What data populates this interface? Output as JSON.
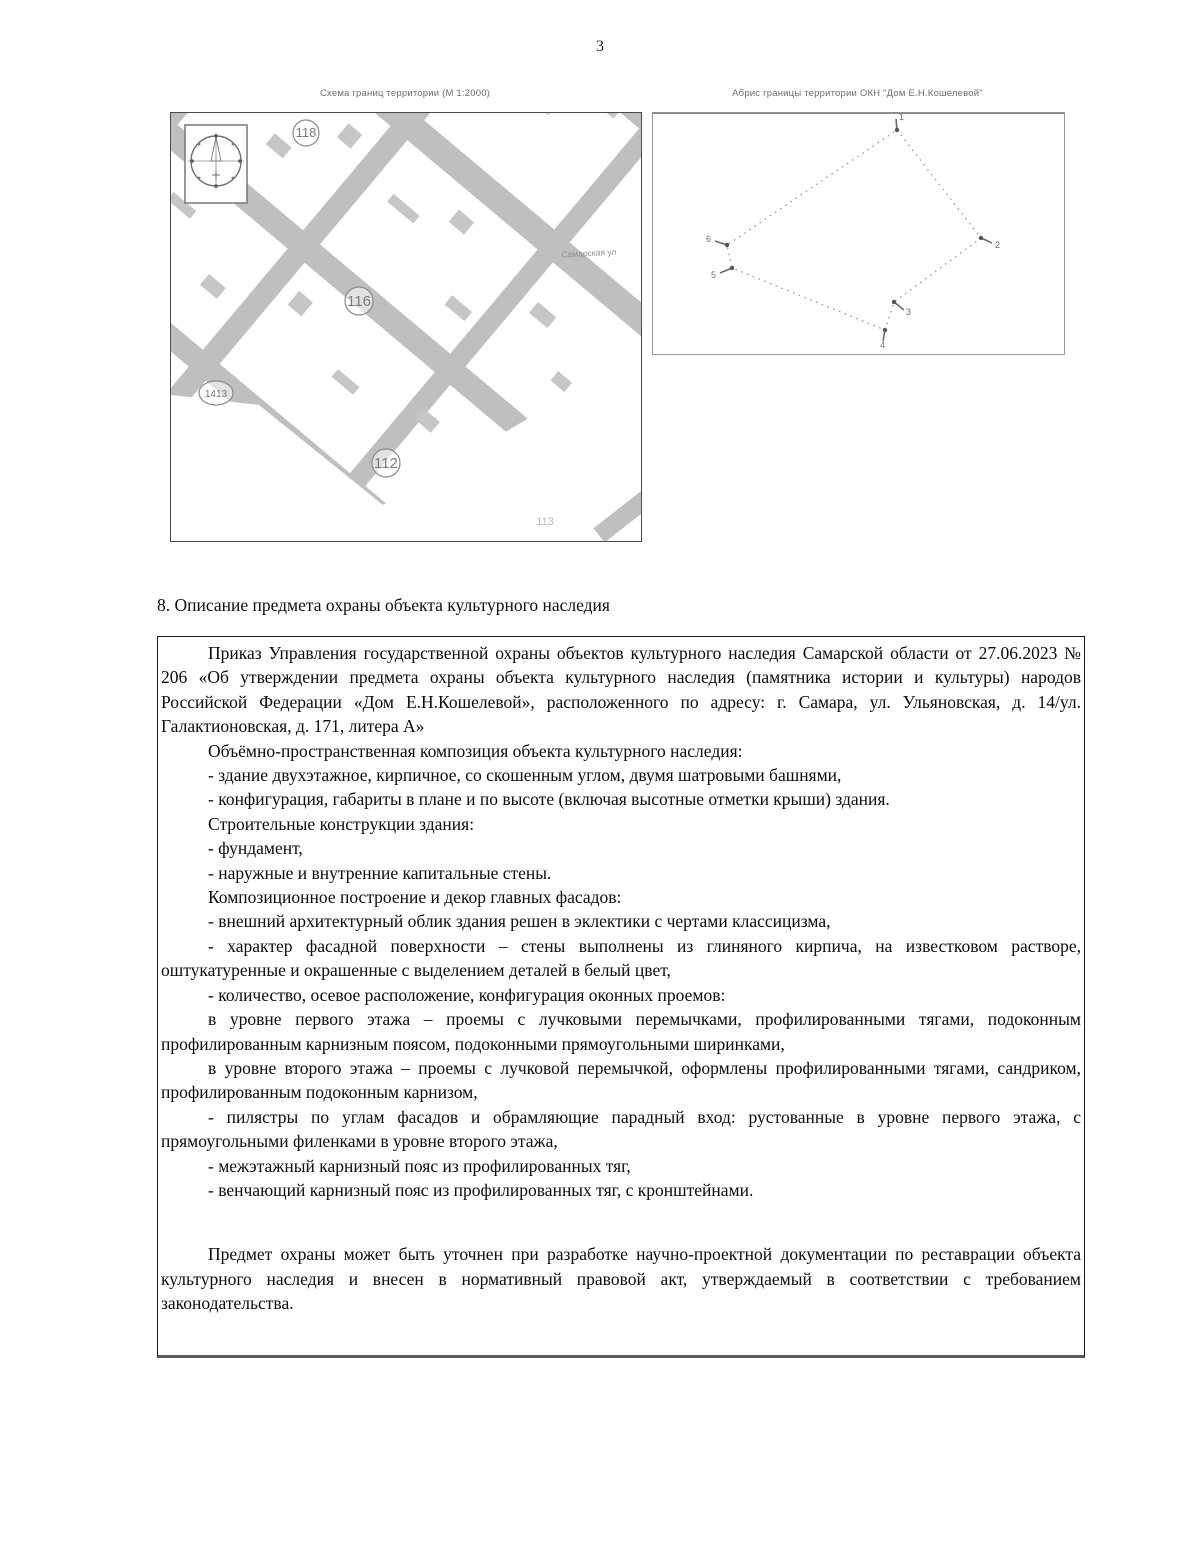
{
  "page": {
    "number": "3"
  },
  "figures": {
    "map": {
      "caption": "Схема границ территории (М 1:2000)",
      "labels": {
        "block_118": "118",
        "block_116": "116",
        "block_1413": "1413",
        "block_112": "112",
        "block_113": "113",
        "street_name": "Самарская ул"
      }
    },
    "abris": {
      "caption": "Абрис границы территории ОКН \"Дом Е.Н.Кошелевой\"",
      "point_labels": [
        "1",
        "2",
        "3",
        "4",
        "5",
        "6"
      ]
    }
  },
  "section": {
    "heading": "8. Описание предмета охраны объекта культурного наследия"
  },
  "body": {
    "paragraphs": [
      "Приказ Управления государственной охраны объектов культурного наследия Самарской области от 27.06.2023 № 206 «Об утверждении предмета охраны объекта культурного наследия (памятника истории и культуры) народов Российской Федерации «Дом Е.Н.Кошелевой», расположенного по адресу: г. Самара, ул. Ульяновская, д. 14/ул. Галактионовская, д. 171, литера А»",
      "Объёмно-пространственная композиция объекта культурного наследия:",
      "- здание двухэтажное, кирпичное, со скошенным углом, двумя шатровыми башнями,",
      "- конфигурация, габариты в плане и по высоте (включая высотные отметки крыши) здания.",
      "Строительные конструкции здания:",
      "- фундамент,",
      "- наружные и внутренние капитальные стены.",
      "Композиционное построение и декор главных фасадов:",
      "- внешний архитектурный облик здания решен в эклектики с чертами классицизма,",
      "- характер фасадной поверхности – стены выполнены из глиняного кирпича, на известковом растворе, оштукатуренные и окрашенные с выделением деталей в белый цвет,",
      "- количество, осевое расположение, конфигурация оконных проемов:",
      "в уровне первого этажа – проемы с лучковыми перемычками, профилированными тягами, подоконным профилированным карнизным поясом, подоконными прямоугольными ширинками,",
      "в уровне второго этажа – проемы с лучковой перемычкой, оформлены профилированными тягами, сандриком, профилированным подоконным карнизом,",
      "- пилястры по углам фасадов и обрамляющие парадный вход: рустованные в уровне первого этажа, с прямоугольными филенками в уровне второго этажа,",
      "- межэтажный карнизный пояс из профилированных тяг,",
      "- венчающий карнизный пояс из профилированных тяг, с кронштейнами.",
      "Предмет охраны может быть уточнен при разработке научно-проектной документации по реставрации объекта культурного наследия и внесен в нормативный правовой акт, утверждаемый в соответствии с требованием законодательства."
    ]
  },
  "colors": {
    "map_street_gray": "#bfbfbf",
    "map_building_gray": "#c6c6c6",
    "map_label_gray": "#7a7a7a",
    "abris_line_gray": "#9a9a9a",
    "text_black": "#0b0b0b"
  }
}
